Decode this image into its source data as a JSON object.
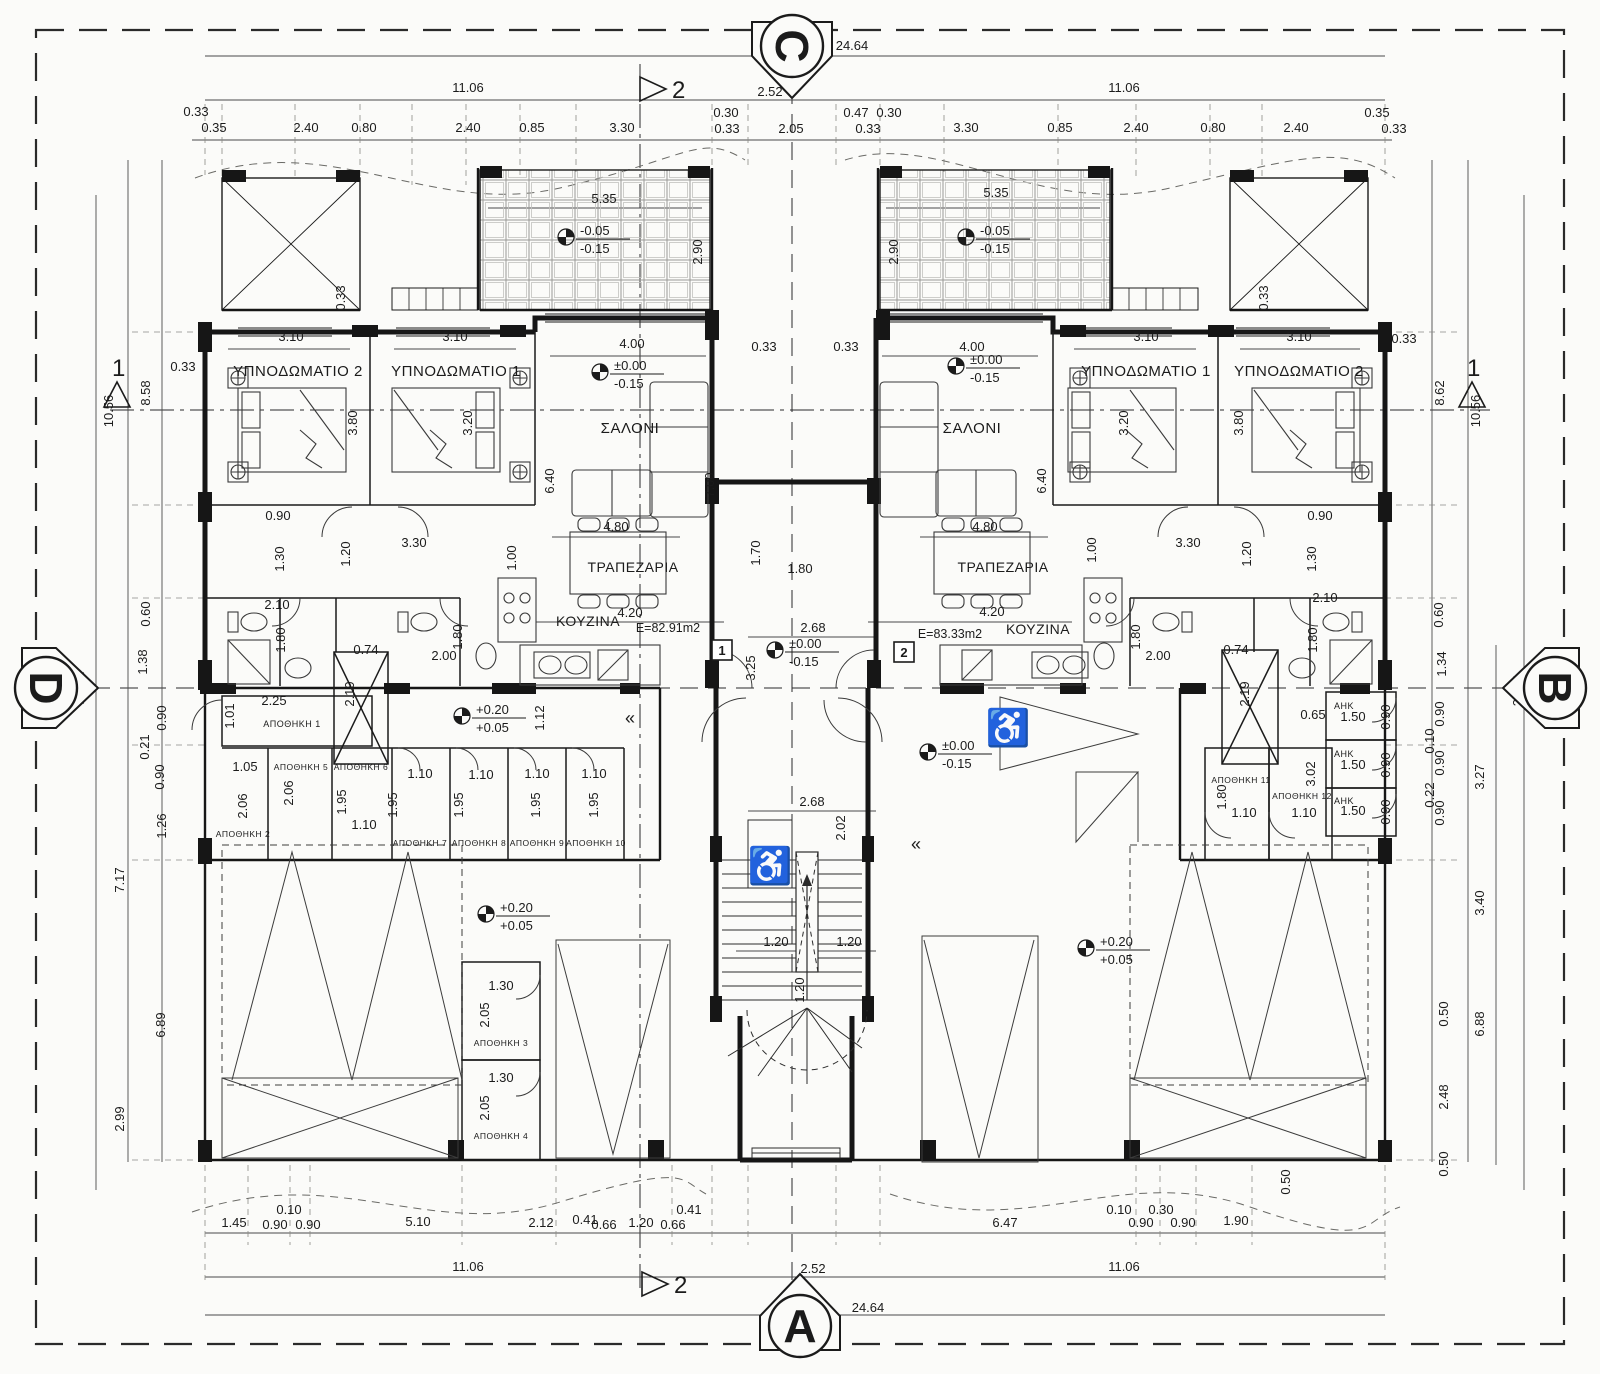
{
  "drawing": {
    "ink": "#1b1b1b",
    "paper": "#fbfbf9",
    "section_markers": [
      {
        "t": "C",
        "x": 792,
        "y": 46,
        "ptr": 0,
        "lrot": 90
      },
      {
        "t": "A",
        "x": 800,
        "y": 1326,
        "ptr": 180,
        "lrot": 0
      },
      {
        "t": "D",
        "x": 46,
        "y": 688,
        "ptr": -90,
        "lrot": 90
      },
      {
        "t": "B",
        "x": 1555,
        "y": 688,
        "ptr": 90,
        "lrot": 90
      }
    ],
    "cut_markers": [
      {
        "t": "2",
        "pts": "640,77 640,101 666,89",
        "lx": 672,
        "ly": 98
      },
      {
        "t": "2",
        "pts": "642,1272 642,1296 668,1284",
        "lx": 674,
        "ly": 1293
      },
      {
        "t": "1",
        "pts": "104,407 130,407 117,382",
        "lx": 112,
        "ly": 376
      },
      {
        "t": "1",
        "pts": "1459,407 1485,407 1472,382",
        "lx": 1467,
        "ly": 376
      }
    ],
    "rooms": [
      {
        "t": "ΥΠΝΟΔΩΜΑΤΙΟ 2",
        "x": 298,
        "y": 376,
        "fs": 15
      },
      {
        "t": "ΥΠΝΟΔΩΜΑΤΙΟ 1",
        "x": 456,
        "y": 376,
        "fs": 15
      },
      {
        "t": "ΣΑΛΟΝΙ",
        "x": 630,
        "y": 433,
        "fs": 15
      },
      {
        "t": "ΤΡΑΠΕΖΑΡΙΑ",
        "x": 633,
        "y": 572,
        "fs": 14
      },
      {
        "t": "ΚΟΥΖΙΝΑ",
        "x": 588,
        "y": 626,
        "fs": 14
      },
      {
        "t": "ΣΑΛΟΝΙ",
        "x": 972,
        "y": 433,
        "fs": 15
      },
      {
        "t": "ΤΡΑΠΕΖΑΡΙΑ",
        "x": 1003,
        "y": 572,
        "fs": 14
      },
      {
        "t": "ΚΟΥΖΙΝΑ",
        "x": 1038,
        "y": 634,
        "fs": 14
      },
      {
        "t": "ΥΠΝΟΔΩΜΑΤΙΟ 1",
        "x": 1146,
        "y": 376,
        "fs": 15
      },
      {
        "t": "ΥΠΝΟΔΩΜΑΤΙΟ 2",
        "x": 1299,
        "y": 376,
        "fs": 15
      },
      {
        "t": "ΑΠΟΘΗΚΗ 1",
        "x": 292,
        "y": 727,
        "fs": 9
      },
      {
        "t": "ΑΠΟΘΗΚΗ 2",
        "x": 243,
        "y": 837,
        "fs": 8.5
      },
      {
        "t": "ΑΠΟΘΗΚΗ 5",
        "x": 301,
        "y": 770,
        "fs": 8.5
      },
      {
        "t": "ΑΠΟΘΗΚΗ 6",
        "x": 361,
        "y": 770,
        "fs": 8.5
      },
      {
        "t": "ΑΠΟΘΗΚΗ 7",
        "x": 420,
        "y": 846,
        "fs": 8.5
      },
      {
        "t": "ΑΠΟΘΗΚΗ 8",
        "x": 479,
        "y": 846,
        "fs": 8.5
      },
      {
        "t": "ΑΠΟΘΗΚΗ 9",
        "x": 537,
        "y": 846,
        "fs": 8.5
      },
      {
        "t": "ΑΠΟΘΗΚΗ 10",
        "x": 596,
        "y": 846,
        "fs": 8.5
      },
      {
        "t": "ΑΠΟΘΗΚΗ 3",
        "x": 501,
        "y": 1046,
        "fs": 8.5
      },
      {
        "t": "ΑΠΟΘΗΚΗ 4",
        "x": 501,
        "y": 1139,
        "fs": 8.5
      },
      {
        "t": "ΑΠΟΘΗΚΗ 11",
        "x": 1241,
        "y": 783,
        "fs": 8.5
      },
      {
        "t": "ΑΠΟΘΗΚΗ 12",
        "x": 1302,
        "y": 799,
        "fs": 8.5
      },
      {
        "t": "ΑΗΚ",
        "x": 1344,
        "y": 709,
        "fs": 9
      },
      {
        "t": "ΑΗΚ",
        "x": 1344,
        "y": 757,
        "fs": 9
      },
      {
        "t": "ΑΗΚ",
        "x": 1344,
        "y": 804,
        "fs": 9
      }
    ],
    "area_labels": [
      {
        "t": "E=82.91m2",
        "x": 668,
        "y": 632
      },
      {
        "t": "E=83.33m2",
        "x": 950,
        "y": 638
      }
    ],
    "apartment_tags": [
      {
        "t": "1",
        "x": 722,
        "y": 654
      },
      {
        "t": "2",
        "x": 904,
        "y": 656
      }
    ],
    "levels": [
      {
        "l1": "-0.05",
        "l2": "-0.15",
        "x": 566,
        "y": 237
      },
      {
        "l1": "-0.05",
        "l2": "-0.15",
        "x": 966,
        "y": 237
      },
      {
        "l1": "±0.00",
        "l2": "-0.15",
        "x": 600,
        "y": 372
      },
      {
        "l1": "±0.00",
        "l2": "-0.15",
        "x": 956,
        "y": 366
      },
      {
        "l1": "±0.00",
        "l2": "-0.15",
        "x": 775,
        "y": 650
      },
      {
        "l1": "±0.00",
        "l2": "-0.15",
        "x": 928,
        "y": 752
      },
      {
        "l1": "+0.20",
        "l2": "+0.05",
        "x": 462,
        "y": 716
      },
      {
        "l1": "+0.20",
        "l2": "+0.05",
        "x": 486,
        "y": 914
      },
      {
        "l1": "+0.20",
        "l2": "+0.05",
        "x": 1086,
        "y": 948
      }
    ],
    "icons": [
      {
        "n": "wheelchair-icon",
        "x": 770,
        "y": 878,
        "glyph": "♿",
        "fs": 36
      },
      {
        "n": "wheelchair-icon",
        "x": 1008,
        "y": 740,
        "glyph": "♿",
        "fs": 36
      },
      {
        "n": "direction-chevron",
        "x": 630,
        "y": 724,
        "glyph": "«",
        "fs": 18
      },
      {
        "n": "direction-chevron",
        "x": 916,
        "y": 850,
        "glyph": "«",
        "fs": 18
      }
    ],
    "dims": [
      {
        "t": "24.64",
        "x": 852,
        "y": 50
      },
      {
        "t": "2.52",
        "x": 770,
        "y": 96
      },
      {
        "t": "11.06",
        "x": 468,
        "y": 92
      },
      {
        "t": "11.06",
        "x": 1124,
        "y": 92
      },
      {
        "t": "0.33",
        "x": 196,
        "y": 116
      },
      {
        "t": "0.35",
        "x": 214,
        "y": 132
      },
      {
        "t": "2.40",
        "x": 306,
        "y": 132
      },
      {
        "t": "0.80",
        "x": 364,
        "y": 132
      },
      {
        "t": "2.40",
        "x": 468,
        "y": 132
      },
      {
        "t": "0.85",
        "x": 532,
        "y": 132
      },
      {
        "t": "3.30",
        "x": 622,
        "y": 132
      },
      {
        "t": "0.30",
        "x": 726,
        "y": 117
      },
      {
        "t": "0.33",
        "x": 727,
        "y": 133
      },
      {
        "t": "2.05",
        "x": 791,
        "y": 133
      },
      {
        "t": "0.47",
        "x": 856,
        "y": 117
      },
      {
        "t": "0.30",
        "x": 889,
        "y": 117
      },
      {
        "t": "0.33",
        "x": 868,
        "y": 133
      },
      {
        "t": "3.30",
        "x": 966,
        "y": 132
      },
      {
        "t": "0.85",
        "x": 1060,
        "y": 132
      },
      {
        "t": "2.40",
        "x": 1136,
        "y": 132
      },
      {
        "t": "0.80",
        "x": 1213,
        "y": 132
      },
      {
        "t": "2.40",
        "x": 1296,
        "y": 132
      },
      {
        "t": "0.35",
        "x": 1377,
        "y": 117
      },
      {
        "t": "0.33",
        "x": 1394,
        "y": 133
      },
      {
        "t": "5.35",
        "x": 604,
        "y": 203
      },
      {
        "t": "2.90",
        "x": 702,
        "y": 252,
        "r": 1
      },
      {
        "t": "5.35",
        "x": 996,
        "y": 197
      },
      {
        "t": "2.90",
        "x": 898,
        "y": 252,
        "r": 1
      },
      {
        "t": "0.33",
        "x": 345,
        "y": 298,
        "r": 1
      },
      {
        "t": "0.33",
        "x": 1268,
        "y": 298,
        "r": 1
      },
      {
        "t": "3.10",
        "x": 291,
        "y": 341
      },
      {
        "t": "3.10",
        "x": 455,
        "y": 341
      },
      {
        "t": "4.00",
        "x": 632,
        "y": 348
      },
      {
        "t": "0.33",
        "x": 764,
        "y": 351
      },
      {
        "t": "0.33",
        "x": 846,
        "y": 351
      },
      {
        "t": "4.00",
        "x": 972,
        "y": 351
      },
      {
        "t": "3.10",
        "x": 1146,
        "y": 341
      },
      {
        "t": "3.10",
        "x": 1299,
        "y": 341
      },
      {
        "t": "0.33",
        "x": 1404,
        "y": 343
      },
      {
        "t": "0.33",
        "x": 183,
        "y": 371
      },
      {
        "t": "3.80",
        "x": 357,
        "y": 423,
        "r": 1
      },
      {
        "t": "3.20",
        "x": 472,
        "y": 423,
        "r": 1
      },
      {
        "t": "3.20",
        "x": 1128,
        "y": 423,
        "r": 1
      },
      {
        "t": "3.80",
        "x": 1243,
        "y": 423,
        "r": 1
      },
      {
        "t": "6.40",
        "x": 554,
        "y": 481,
        "r": 1
      },
      {
        "t": "7.00",
        "x": 714,
        "y": 485,
        "r": 1
      },
      {
        "t": "6.40",
        "x": 1046,
        "y": 481,
        "r": 1
      },
      {
        "t": "10.56",
        "x": 113,
        "y": 411,
        "r": 1
      },
      {
        "t": "8.58",
        "x": 150,
        "y": 393,
        "r": 1
      },
      {
        "t": "8.62",
        "x": 1444,
        "y": 393,
        "r": 1
      },
      {
        "t": "10.56",
        "x": 1480,
        "y": 411,
        "r": 1
      },
      {
        "t": "20.72",
        "x": 84,
        "y": 688,
        "r": 1
      },
      {
        "t": "20.71",
        "x": 1522,
        "y": 690,
        "r": 1
      },
      {
        "t": "0.90",
        "x": 278,
        "y": 520
      },
      {
        "t": "1.30",
        "x": 284,
        "y": 559,
        "r": 1
      },
      {
        "t": "3.30",
        "x": 414,
        "y": 547
      },
      {
        "t": "1.20",
        "x": 350,
        "y": 554,
        "r": 1
      },
      {
        "t": "1.00",
        "x": 516,
        "y": 558,
        "r": 1
      },
      {
        "t": "4.80",
        "x": 616,
        "y": 531
      },
      {
        "t": "2.10",
        "x": 277,
        "y": 609
      },
      {
        "t": "1.80",
        "x": 285,
        "y": 640,
        "r": 1
      },
      {
        "t": "0.74",
        "x": 366,
        "y": 654
      },
      {
        "t": "2.19",
        "x": 354,
        "y": 694,
        "r": 1
      },
      {
        "t": "2.00",
        "x": 444,
        "y": 660
      },
      {
        "t": "1.80",
        "x": 462,
        "y": 637,
        "r": 1
      },
      {
        "t": "4.20",
        "x": 630,
        "y": 617
      },
      {
        "t": "1.70",
        "x": 760,
        "y": 553,
        "r": 1
      },
      {
        "t": "1.80",
        "x": 800,
        "y": 573
      },
      {
        "t": "2.68",
        "x": 813,
        "y": 632
      },
      {
        "t": "3.25",
        "x": 755,
        "y": 668,
        "r": 1
      },
      {
        "t": "4.80",
        "x": 985,
        "y": 531
      },
      {
        "t": "4.20",
        "x": 992,
        "y": 616
      },
      {
        "t": "1.00",
        "x": 1096,
        "y": 550,
        "r": 1
      },
      {
        "t": "3.30",
        "x": 1188,
        "y": 547
      },
      {
        "t": "0.90",
        "x": 1320,
        "y": 520
      },
      {
        "t": "1.30",
        "x": 1316,
        "y": 559,
        "r": 1
      },
      {
        "t": "1.20",
        "x": 1251,
        "y": 554,
        "r": 1
      },
      {
        "t": "2.10",
        "x": 1325,
        "y": 602
      },
      {
        "t": "1.80",
        "x": 1317,
        "y": 640,
        "r": 1
      },
      {
        "t": "0.74",
        "x": 1236,
        "y": 654
      },
      {
        "t": "2.19",
        "x": 1249,
        "y": 694,
        "r": 1
      },
      {
        "t": "2.00",
        "x": 1158,
        "y": 660
      },
      {
        "t": "1.80",
        "x": 1140,
        "y": 637,
        "r": 1
      },
      {
        "t": "0.60",
        "x": 150,
        "y": 614,
        "r": 1
      },
      {
        "t": "1.38",
        "x": 147,
        "y": 662,
        "r": 1
      },
      {
        "t": "0.90",
        "x": 166,
        "y": 718,
        "r": 1
      },
      {
        "t": "0.21",
        "x": 149,
        "y": 747,
        "r": 1
      },
      {
        "t": "0.90",
        "x": 164,
        "y": 777,
        "r": 1
      },
      {
        "t": "1.26",
        "x": 166,
        "y": 826,
        "r": 1
      },
      {
        "t": "7.17",
        "x": 124,
        "y": 880,
        "r": 1
      },
      {
        "t": "6.89",
        "x": 165,
        "y": 1025,
        "r": 1
      },
      {
        "t": "2.99",
        "x": 124,
        "y": 1119,
        "r": 1
      },
      {
        "t": "0.60",
        "x": 1443,
        "y": 615,
        "r": 1
      },
      {
        "t": "1.34",
        "x": 1446,
        "y": 664,
        "r": 1
      },
      {
        "t": "0.90",
        "x": 1444,
        "y": 714,
        "r": 1
      },
      {
        "t": "0.10",
        "x": 1434,
        "y": 741,
        "r": 1
      },
      {
        "t": "0.90",
        "x": 1444,
        "y": 763,
        "r": 1
      },
      {
        "t": "0.22",
        "x": 1434,
        "y": 795,
        "r": 1
      },
      {
        "t": "0.90",
        "x": 1444,
        "y": 813,
        "r": 1
      },
      {
        "t": "3.27",
        "x": 1484,
        "y": 777,
        "r": 1
      },
      {
        "t": "3.40",
        "x": 1484,
        "y": 903,
        "r": 1
      },
      {
        "t": "0.50",
        "x": 1448,
        "y": 1014,
        "r": 1
      },
      {
        "t": "6.88",
        "x": 1484,
        "y": 1024,
        "r": 1
      },
      {
        "t": "2.48",
        "x": 1448,
        "y": 1097,
        "r": 1
      },
      {
        "t": "0.50",
        "x": 1448,
        "y": 1164,
        "r": 1
      },
      {
        "t": "2.25",
        "x": 274,
        "y": 705
      },
      {
        "t": "1.01",
        "x": 234,
        "y": 716,
        "r": 1
      },
      {
        "t": "1.12",
        "x": 544,
        "y": 718,
        "r": 1
      },
      {
        "t": "1.05",
        "x": 245,
        "y": 771
      },
      {
        "t": "2.06",
        "x": 247,
        "y": 806,
        "r": 1
      },
      {
        "t": "2.06",
        "x": 293,
        "y": 793,
        "r": 1
      },
      {
        "t": "1.95",
        "x": 346,
        "y": 802,
        "r": 1
      },
      {
        "t": "1.10",
        "x": 364,
        "y": 829
      },
      {
        "t": "1.95",
        "x": 397,
        "y": 805,
        "r": 1
      },
      {
        "t": "1.10",
        "x": 420,
        "y": 778
      },
      {
        "t": "1.95",
        "x": 463,
        "y": 805,
        "r": 1
      },
      {
        "t": "1.10",
        "x": 481,
        "y": 779
      },
      {
        "t": "1.95",
        "x": 540,
        "y": 805,
        "r": 1
      },
      {
        "t": "1.10",
        "x": 537,
        "y": 778
      },
      {
        "t": "1.95",
        "x": 598,
        "y": 805,
        "r": 1
      },
      {
        "t": "1.10",
        "x": 594,
        "y": 778
      },
      {
        "t": "0.65",
        "x": 1313,
        "y": 719
      },
      {
        "t": "3.02",
        "x": 1315,
        "y": 774,
        "r": 1
      },
      {
        "t": "1.80",
        "x": 1226,
        "y": 797,
        "r": 1
      },
      {
        "t": "1.10",
        "x": 1244,
        "y": 817
      },
      {
        "t": "1.10",
        "x": 1304,
        "y": 817
      },
      {
        "t": "1.50",
        "x": 1353,
        "y": 721
      },
      {
        "t": "0.90",
        "x": 1390,
        "y": 717,
        "r": 1
      },
      {
        "t": "1.50",
        "x": 1353,
        "y": 769
      },
      {
        "t": "0.90",
        "x": 1390,
        "y": 765,
        "r": 1
      },
      {
        "t": "1.50",
        "x": 1353,
        "y": 815
      },
      {
        "t": "0.90",
        "x": 1390,
        "y": 812,
        "r": 1
      },
      {
        "t": "2.68",
        "x": 812,
        "y": 806
      },
      {
        "t": "2.02",
        "x": 845,
        "y": 828,
        "r": 1
      },
      {
        "t": "1.20",
        "x": 776,
        "y": 946
      },
      {
        "t": "1.20",
        "x": 849,
        "y": 946
      },
      {
        "t": "1.20",
        "x": 804,
        "y": 990,
        "r": 1
      },
      {
        "t": "1.30",
        "x": 501,
        "y": 990
      },
      {
        "t": "2.05",
        "x": 489,
        "y": 1015,
        "r": 1
      },
      {
        "t": "1.30",
        "x": 501,
        "y": 1082
      },
      {
        "t": "2.05",
        "x": 489,
        "y": 1108,
        "r": 1
      },
      {
        "t": "1.45",
        "x": 234,
        "y": 1227
      },
      {
        "t": "0.90",
        "x": 275,
        "y": 1229
      },
      {
        "t": "0.10",
        "x": 289,
        "y": 1214
      },
      {
        "t": "0.90",
        "x": 308,
        "y": 1229
      },
      {
        "t": "5.10",
        "x": 418,
        "y": 1226
      },
      {
        "t": "2.12",
        "x": 541,
        "y": 1227
      },
      {
        "t": "0.41",
        "x": 585,
        "y": 1224
      },
      {
        "t": "0.66",
        "x": 604,
        "y": 1229
      },
      {
        "t": "1.20",
        "x": 641,
        "y": 1227
      },
      {
        "t": "0.66",
        "x": 673,
        "y": 1229
      },
      {
        "t": "0.41",
        "x": 689,
        "y": 1214
      },
      {
        "t": "6.47",
        "x": 1005,
        "y": 1227
      },
      {
        "t": "0.10",
        "x": 1119,
        "y": 1214
      },
      {
        "t": "0.30",
        "x": 1161,
        "y": 1214
      },
      {
        "t": "0.90",
        "x": 1141,
        "y": 1227
      },
      {
        "t": "0.90",
        "x": 1183,
        "y": 1227
      },
      {
        "t": "1.90",
        "x": 1236,
        "y": 1225
      },
      {
        "t": "0.50",
        "x": 1290,
        "y": 1182,
        "r": 1
      },
      {
        "t": "11.06",
        "x": 468,
        "y": 1271
      },
      {
        "t": "2.52",
        "x": 813,
        "y": 1273
      },
      {
        "t": "11.06",
        "x": 1124,
        "y": 1271
      },
      {
        "t": "24.64",
        "x": 868,
        "y": 1312
      }
    ]
  }
}
